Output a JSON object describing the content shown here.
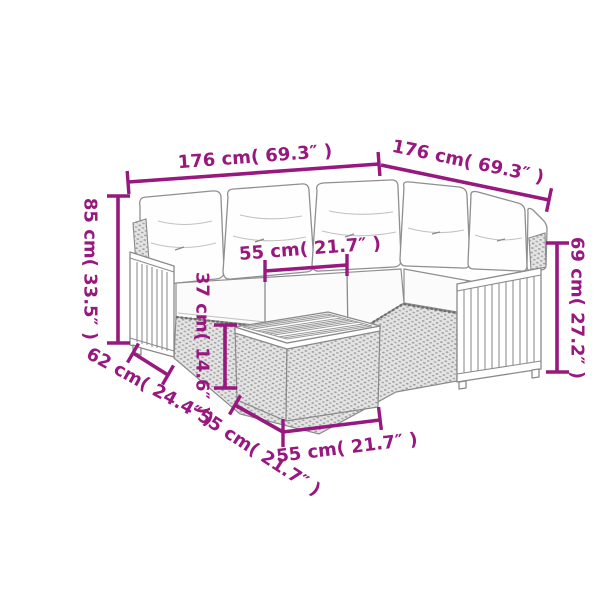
{
  "diagram": {
    "type": "product-dimension-diagram",
    "subject": "rattan corner sofa set with cushions and coffee table",
    "accent_color": "#97187E",
    "sketch_color": "#8a8a8a",
    "background_color": "#ffffff",
    "dimensions": {
      "sofa_width_left": "176 cm( 69.3″ )",
      "sofa_width_right": "176 cm( 69.3″ )",
      "back_height": "85 cm( 33.5″ )",
      "seat_width": "55 cm( 21.7″ )",
      "seat_height": "37 cm( 14.6″ )",
      "sofa_depth": "62 cm( 24.4″ )",
      "table_depth": "55 cm( 21.7″ )",
      "table_width": "55 cm( 21.7″ )",
      "armrest_height": "69 cm( 27.2″ )"
    }
  }
}
